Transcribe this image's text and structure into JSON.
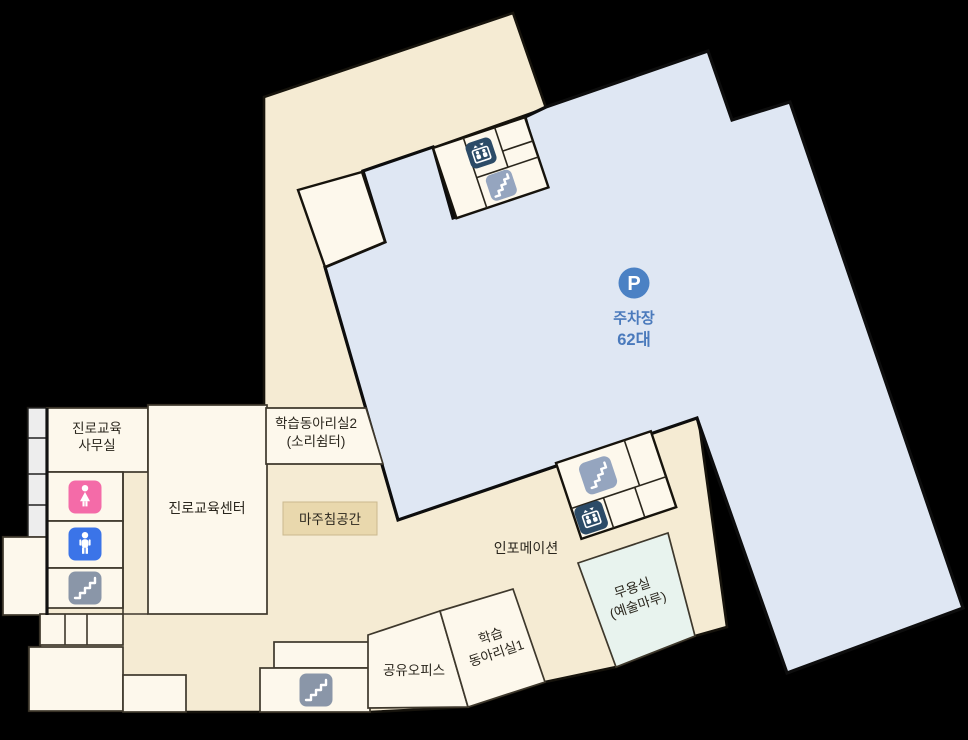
{
  "colors": {
    "background": "#000000",
    "corridor": "#f5ebd3",
    "room": "#fdf8ec",
    "wall": "#1b170e",
    "parking_fill": "#dfe7f3",
    "parking_badge": "#4b81c4",
    "parking_text": "#4a7abc",
    "dance_fill": "#e8f3ee",
    "label_box": "#e9d8ad",
    "strip": "#ededed",
    "icon_female": "#f46ba8",
    "icon_male": "#3b74e8",
    "icon_stairs": "#8a96a8",
    "icon_stairs_light": "#95a5bf",
    "icon_elevator": "#2c4b67"
  },
  "parking": {
    "badge": "P",
    "name": "주차장",
    "capacity": "62대"
  },
  "rooms": {
    "career_office": {
      "line1": "진로교육",
      "line2": "사무실"
    },
    "career_center": {
      "label": "진로교육센터"
    },
    "study_club2": {
      "line1": "학습동아리실2",
      "line2": "(소리쉼터)"
    },
    "meeting_space": {
      "label": "마주침공간"
    },
    "information": {
      "label": "인포메이션"
    },
    "shared_office": {
      "label": "공유오피스"
    },
    "study_club1": {
      "line1": "학습",
      "line2": "동아리실1"
    },
    "dance_room": {
      "line1": "무용실",
      "line2": "(예술마루)"
    }
  },
  "icons": {
    "female_toilet": "female-toilet",
    "male_toilet": "male-toilet",
    "stairs": "stairs",
    "elevator": "elevator",
    "parking": "parking"
  }
}
